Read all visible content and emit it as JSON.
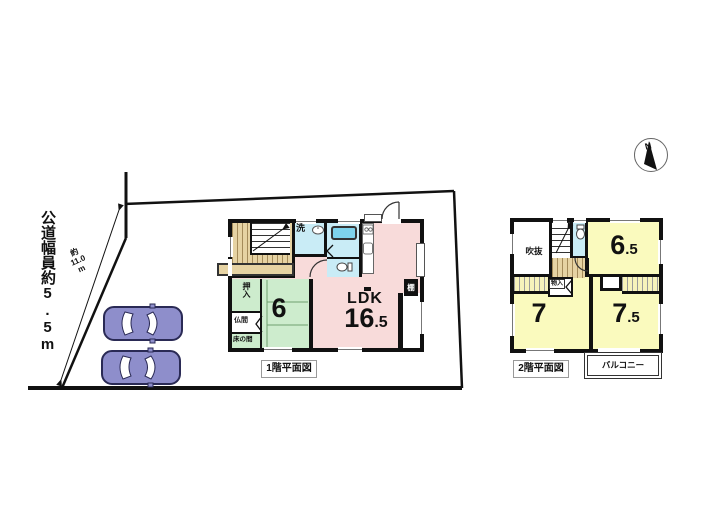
{
  "compass": {
    "north_label": "N"
  },
  "site": {
    "road_width_text": "公道幅員約5.5m",
    "frontage_dim": {
      "prefix": "約",
      "value": "11.0",
      "unit": "m"
    }
  },
  "floor1": {
    "caption": "1階平面図",
    "ldk": {
      "name": "LDK",
      "size_int": "16",
      "size_dec": ".5"
    },
    "tatami_room": {
      "size": "6"
    },
    "labels": {
      "laundry": "洗",
      "closet": "押入",
      "butsuma": "仏間",
      "tokonoma": "床の間",
      "shelf": "棚"
    }
  },
  "floor2": {
    "caption": "2階平面図",
    "rooms": {
      "r65_int": "6",
      "r65_dec": ".5",
      "r7": "7",
      "r75_int": "7",
      "r75_dec": ".5"
    },
    "labels": {
      "void": "吹抜",
      "storage": "物入",
      "balcony": "バルコニー"
    }
  },
  "colors": {
    "ldk_pink": "#f8dbda",
    "tatami_green": "#cdeccd",
    "room_yellow": "#fafabe",
    "wet_blue": "#c9ecf6",
    "tub_blue": "#7ed3ec",
    "wood_tan": "#e6d3a3",
    "wall_black": "#111111",
    "car_purple": "#8e8ecb"
  }
}
